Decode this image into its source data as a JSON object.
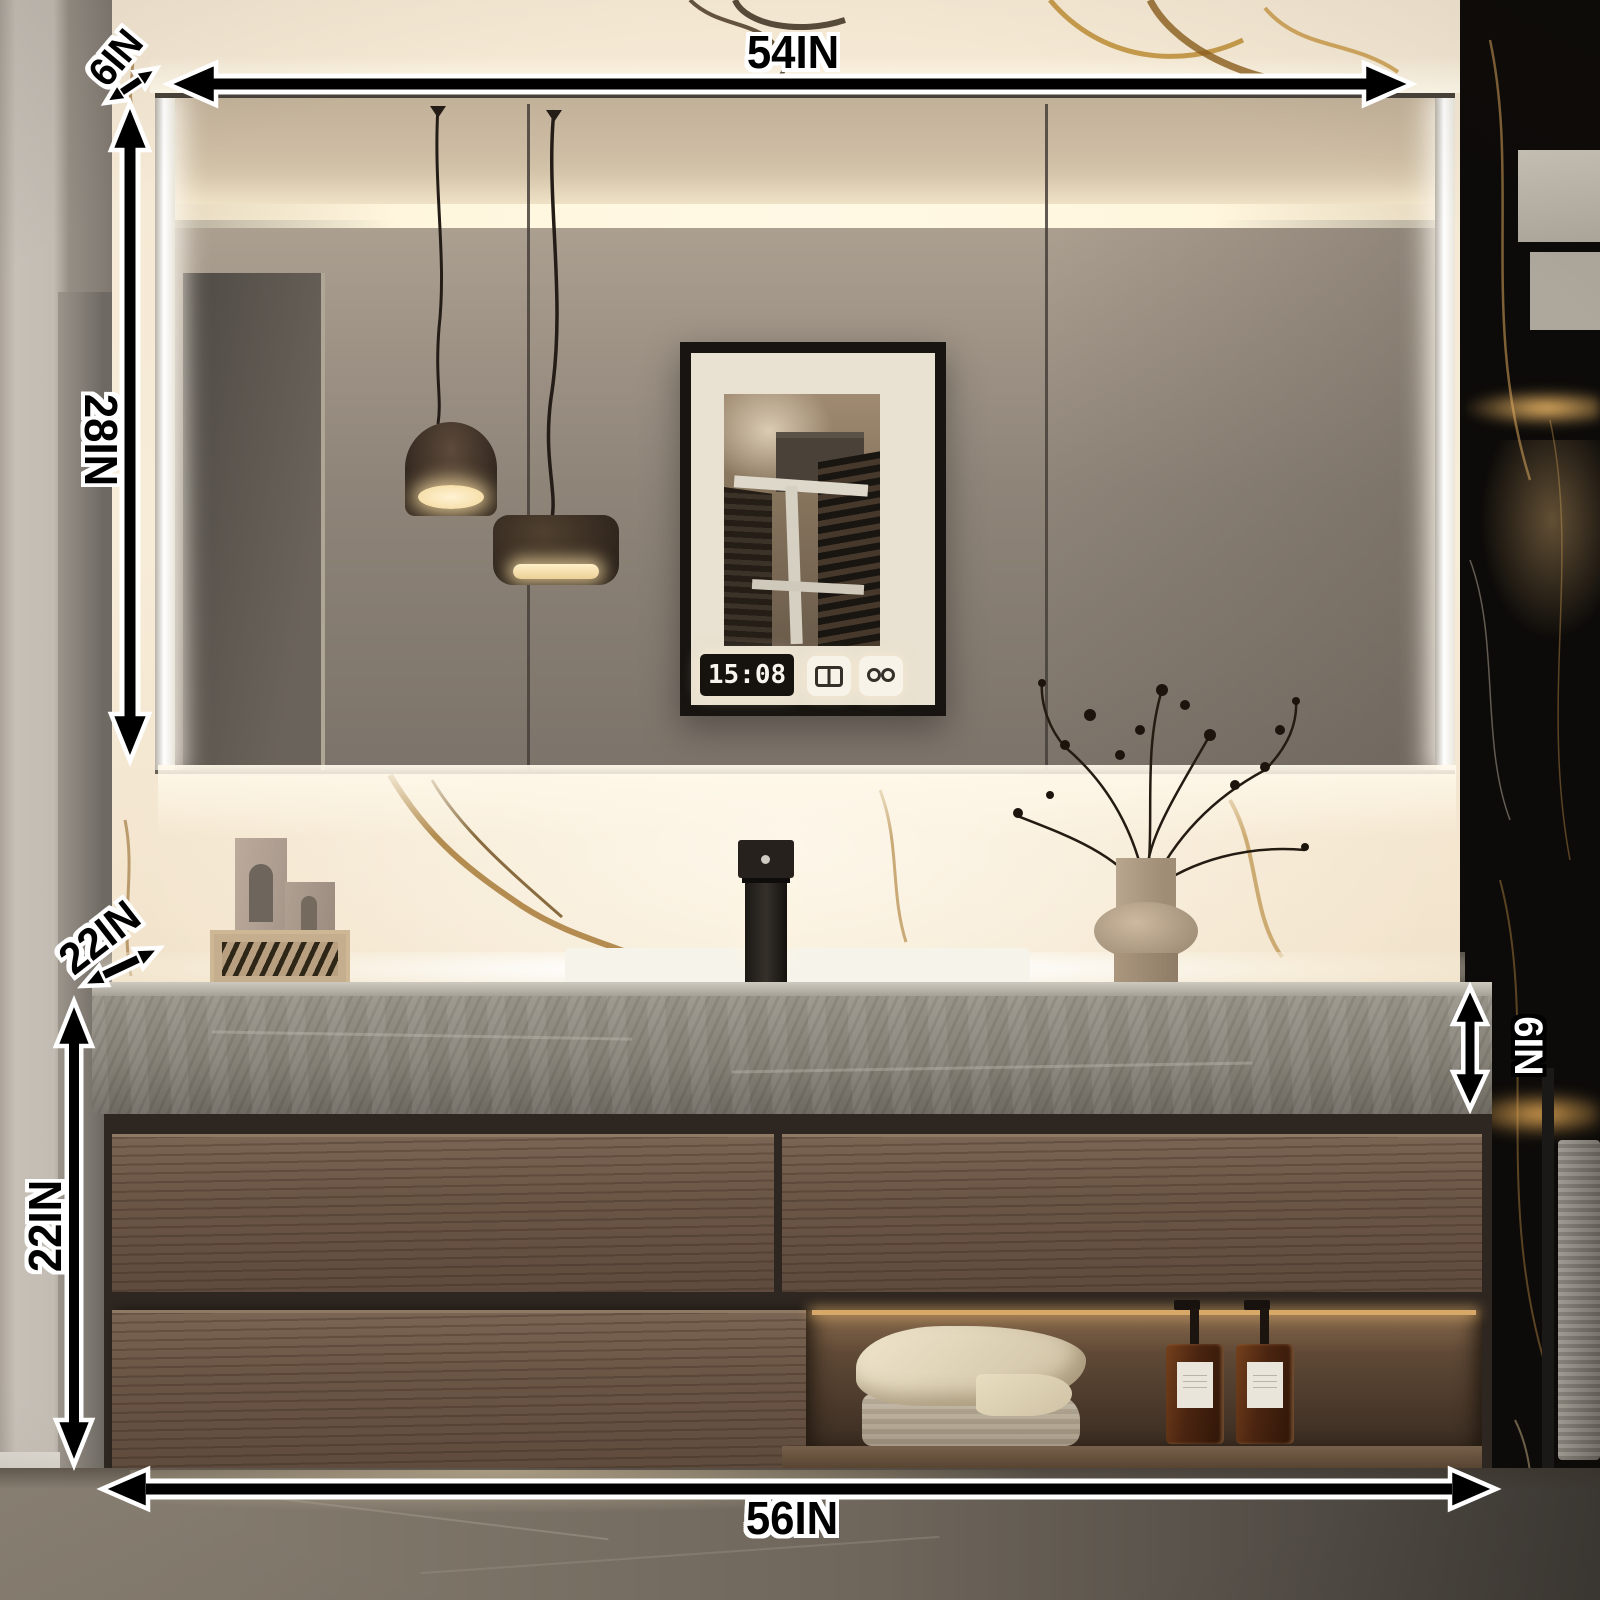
{
  "product_labels": {
    "mirror_width": "54IN",
    "mirror_depth": "6IN",
    "mirror_height": "28IN",
    "countertop_depth": "22IN",
    "cabinet_height": "22IN",
    "countertop_thickness": "6IN",
    "vanity_width": "56IN"
  },
  "mirror_display": {
    "time": "15:08"
  },
  "colors": {
    "annotation_text": "#000000",
    "annotation_outline": "#ffffff",
    "annotation_inverse_text": "#ffffff",
    "led_glow": "#fff6dd",
    "marble_backsplash": "#f5e9d4",
    "marble_gold_vein": "#a97b2f",
    "black_marble": "#0d0b09",
    "wood_cabinet": "#6b5646",
    "countertop_stone": "#8a857b",
    "amber_bottle": "#4a2410",
    "towel_cream": "#e9dfc6"
  }
}
